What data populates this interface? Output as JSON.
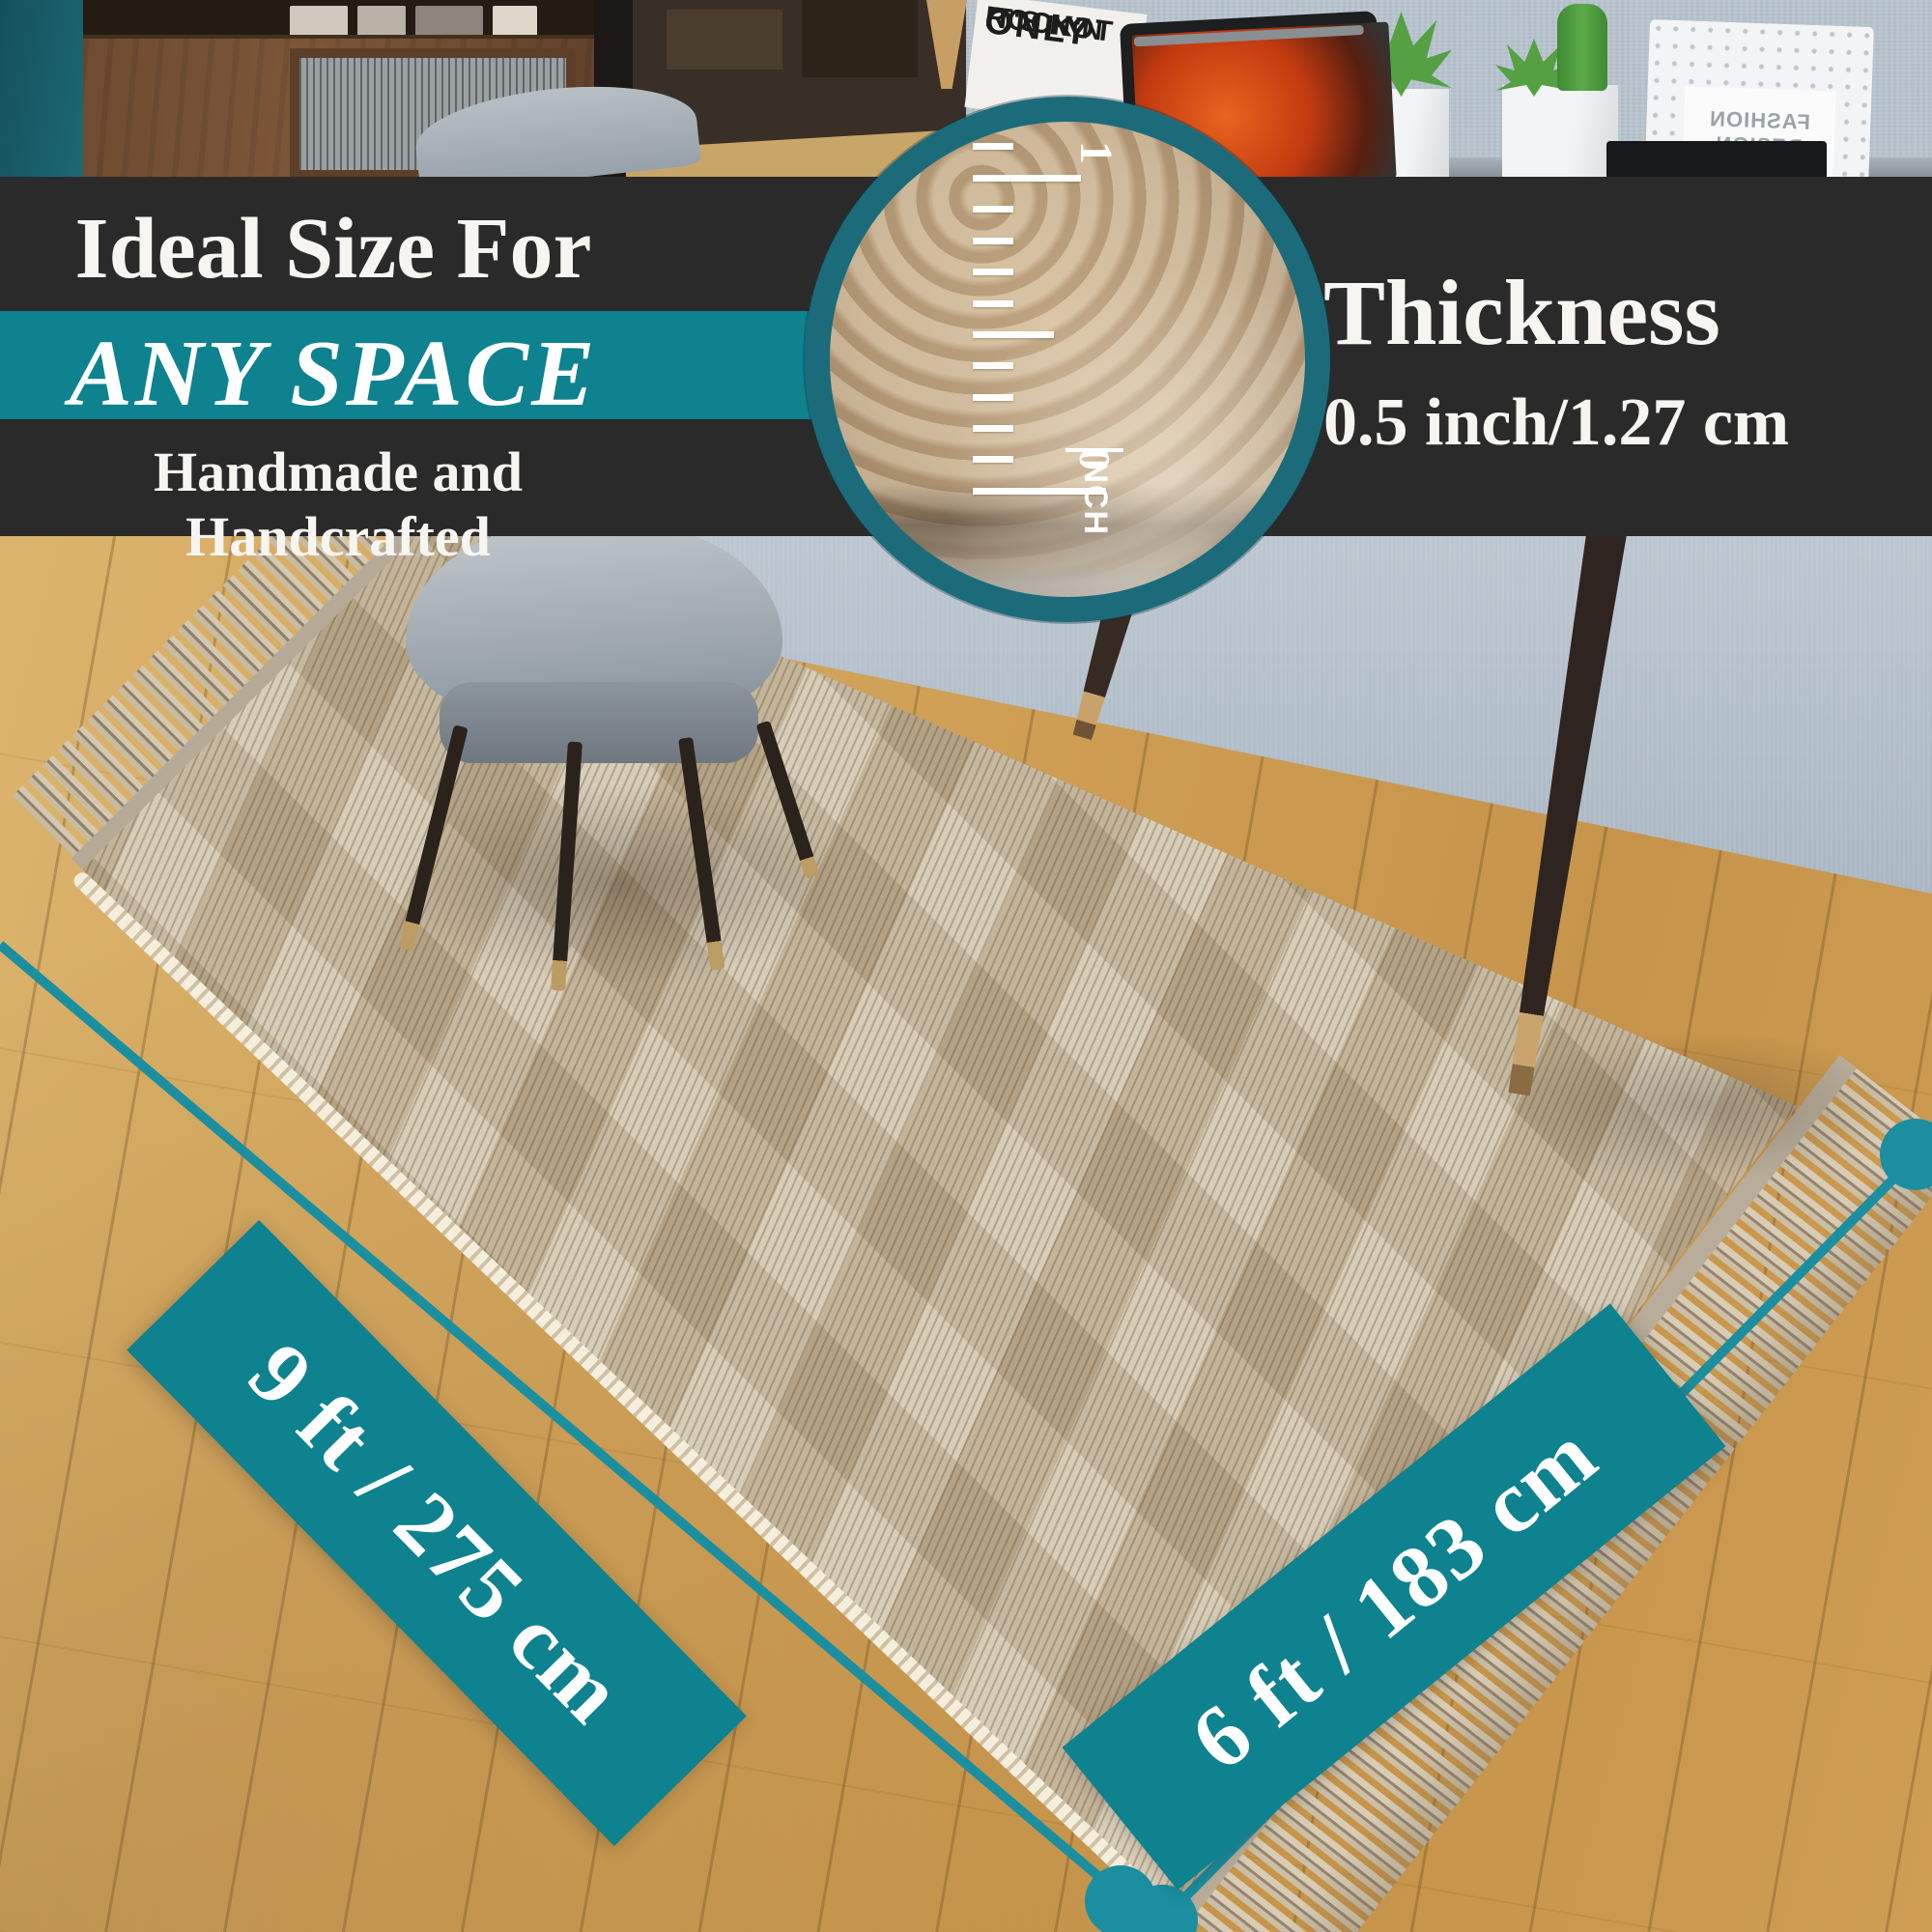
{
  "colors": {
    "teal_stripe": "#0e828f",
    "teal_line": "#1b8fa0",
    "teal_ring": "#1c6b7a",
    "banner_dark": "#2b2a2a"
  },
  "banner": {
    "line1": "Ideal Size For",
    "line2": "ANY SPACE",
    "line3": "Handmade and Handcrafted"
  },
  "thickness": {
    "title": "Thickness",
    "value": "0.5 inch/1.27 cm"
  },
  "inset_ruler": {
    "one": "1",
    "zero": "0",
    "unit": "INCH"
  },
  "dimensions": {
    "length_label": "9 ft / 275 cm",
    "width_label": "6 ft / 183 cm"
  },
  "scene": {
    "poster": {
      "line1": "IT'S NOT",
      "line2": "ONLY",
      "line3": "ROCK'N"
    },
    "frame_text": "FASHION DESIGN"
  }
}
